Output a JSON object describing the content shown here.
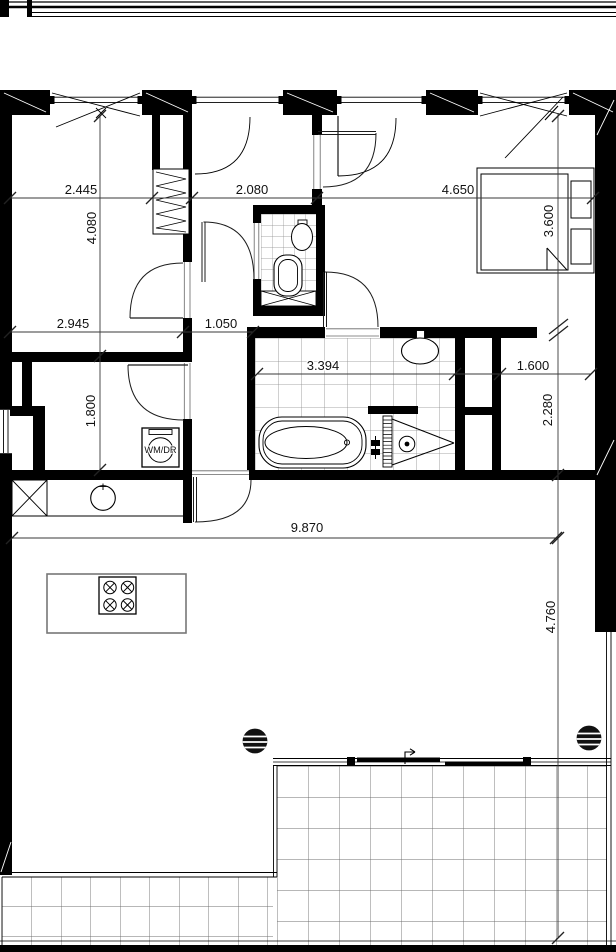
{
  "dims": {
    "d2445": "2.445",
    "d2080": "2.080",
    "d4650": "4.650",
    "d4080": "4.080",
    "d3600": "3.600",
    "d2945": "2.945",
    "d1050": "1.050",
    "d3394": "3.394",
    "d1600": "1.600",
    "d1800": "1.800",
    "d2280": "2.280",
    "d9870": "9.870",
    "d4760": "4.760"
  },
  "labels": {
    "washer_dryer": "WM/DR"
  },
  "colors": {
    "wall": "#000000",
    "dim_line": "#3a3a3a",
    "tile_line": "#8a8a8a"
  }
}
